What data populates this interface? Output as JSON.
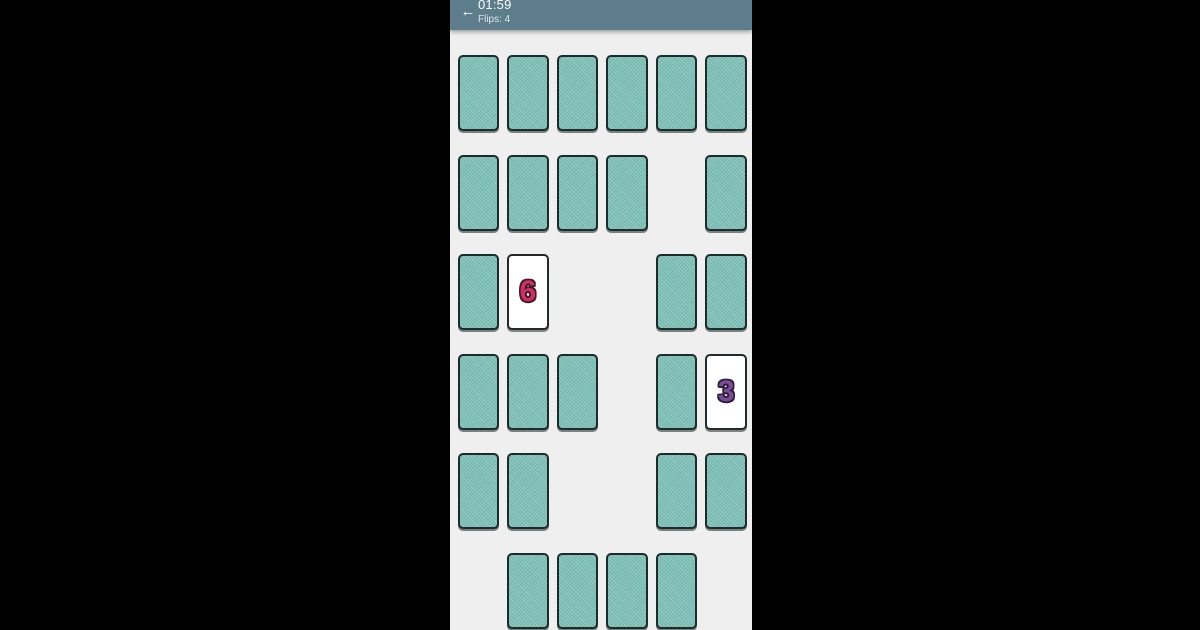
{
  "top_bar": {
    "back_icon": "←",
    "timer": "01:59",
    "flips": "Flips: 4"
  },
  "colors": {
    "letterbox": "#000000",
    "screen_background": "#efefef",
    "bar": "#5e7d8c",
    "bar_text": "#fafafa",
    "card_back": "#7dc0b6",
    "card_border": "#1d2c2b",
    "card_face": "#ffffff",
    "value_6": "#ce3064",
    "value_6_outline": "#43192c",
    "value_3": "#7b4a99",
    "value_3_outline": "#2c1f38"
  },
  "board": {
    "rows": 6,
    "cols": 6,
    "cells": [
      [
        "down",
        "down",
        "down",
        "down",
        "down",
        "down"
      ],
      [
        "down",
        "down",
        "down",
        "down",
        "empty",
        "down"
      ],
      [
        "down",
        "up:6",
        "empty",
        "empty",
        "down",
        "down"
      ],
      [
        "down",
        "down",
        "down",
        "empty",
        "down",
        "up:3"
      ],
      [
        "down",
        "down",
        "empty",
        "empty",
        "down",
        "down"
      ],
      [
        "empty",
        "down",
        "down",
        "down",
        "down",
        "empty"
      ]
    ],
    "face_up_values": [
      "6",
      "3"
    ]
  }
}
